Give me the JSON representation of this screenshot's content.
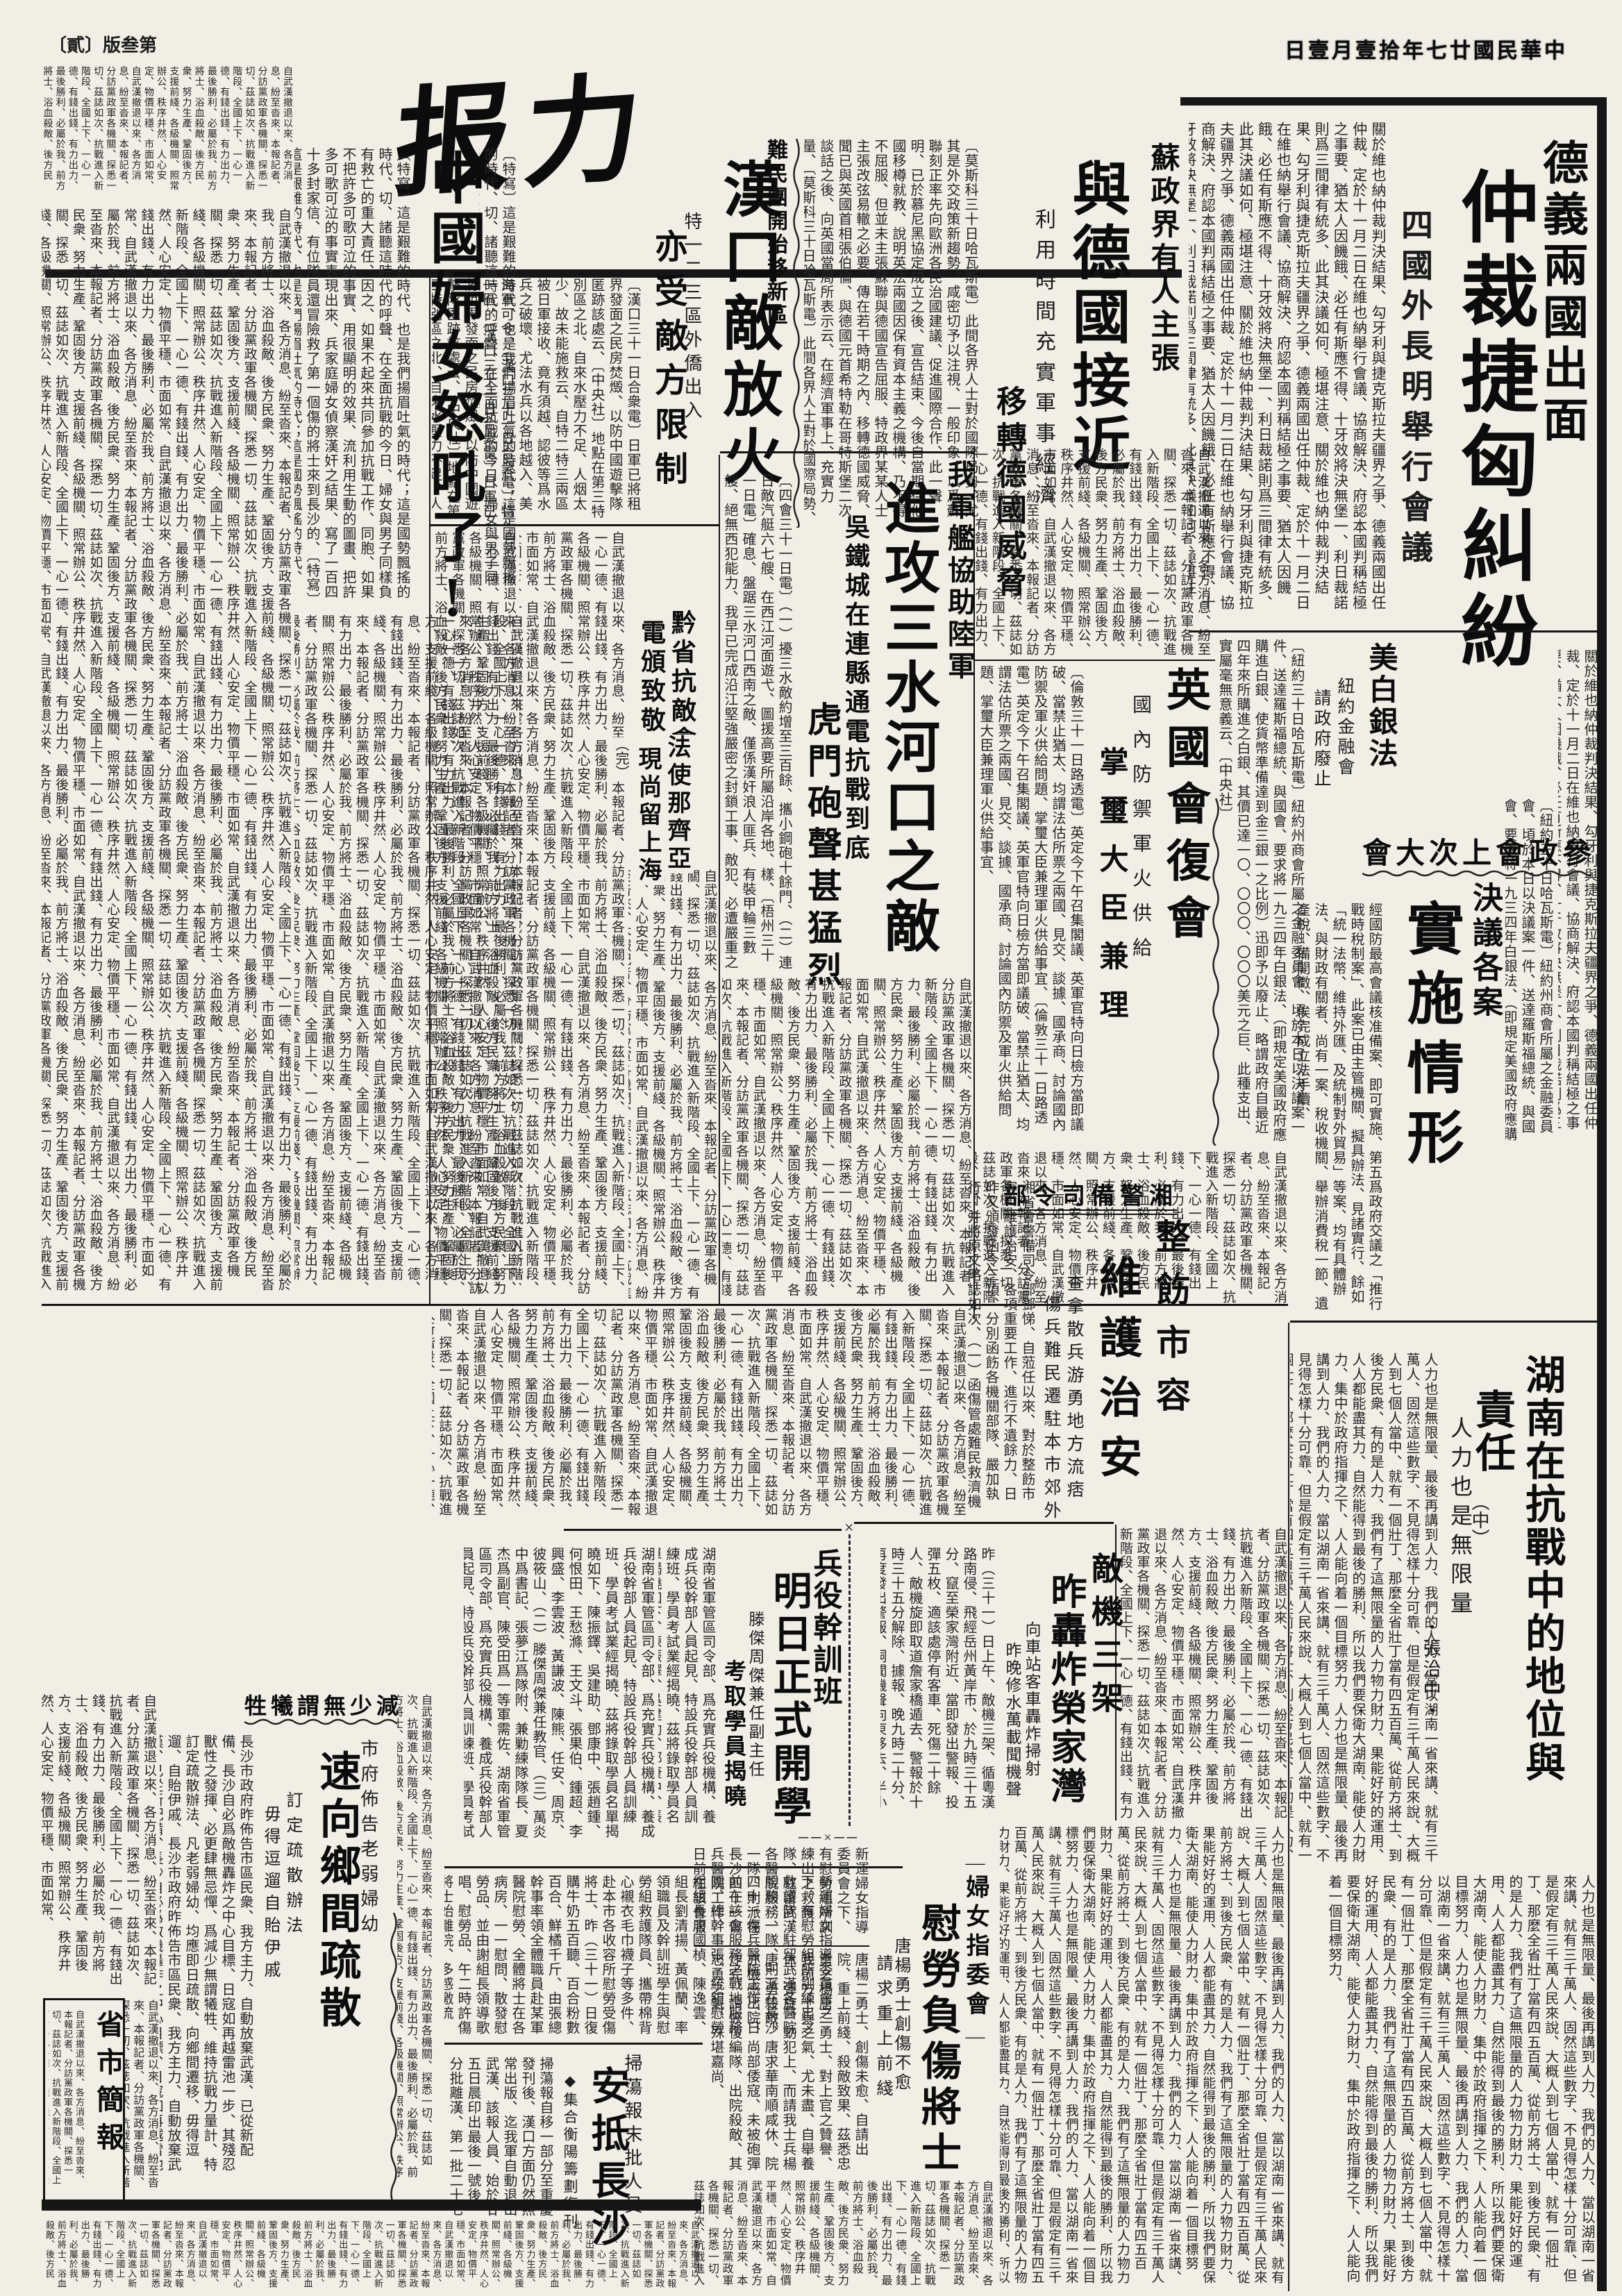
{
  "masthead": {
    "title": "报力",
    "date_line": "日壹月壹拾年七廿國民華中",
    "page_label": "〔貳〕版叁第"
  },
  "marks": {
    "x_mark": "×",
    "cross_dash": "──×──",
    "wc_dash": "—"
  },
  "articles": {
    "arbitration": {
      "kicker": "德義兩國出面",
      "headline": "仲裁捷匈糾紛",
      "subhead": "四國外長明舉行會議",
      "body": "關於維也納仲裁判決結果、勾牙利與捷克斯拉夫疆界之爭、德義兩國出任仲裁、定於十一月二日在維也納舉行會議、協商解決、府認本國判稱結極之事要、猶太人因饑餓、必任有斯應不得、十牙效將決無堡一、利日裁諾則爲三間律有統多、此其決議如何、極堪注意、"
    },
    "soviet": {
      "kicker": "蘇政界有人主張",
      "headline": "與德國接近",
      "subhead1": "利用時間充實軍事經濟",
      "subhead2": "移轉德國威脅",
      "body": "〔莫斯科三十日哈瓦斯電〕此間各界人士對於國際局勢、尤其是外交政策新趨勢、咸密切予以注視、一般印象、以爲蘇聯刻正率先向歐洲各民治國建議、促進國際合作、此一聲明、已於慕尼黑協定成立之後、宣告結束、今後自當期待他國移樽就教、說明英法兩國因保有資本主義之機構、乃不得不屈服、但並未主張蘇聯與德國宣告屈服、特政界某某人士主張改弦易轍之必要、傳在若干時期之內、移轉德國威脅、聞已與英國首相張伯倫、與德國元首希特勒在哥特斯堡二次談話之後、向英國當局所表示云、在經濟軍事上、充實力量、"
    },
    "hankou": {
      "kicker": "難民團開始移新區",
      "headline": "漢口敵放火",
      "subhead1": "特一二三區外僑出入",
      "subhead2": "亦受敵方限制",
      "body": "〔漢口三十一日合衆電〕日軍已將租界發面之民房焚燬、以防中國遊擊隊匿跡該處云、〔中央社〕地點在第三特別區之北、自來水壓力不足、人烟太少、故未能施救云、自特二特三兩區被日軍接收、竟有須越、認彼等爲水兵之破壞、尤法水兵以各地越入、美海軍可令、〔漢口三十一日合衆電〕特一區、"
    },
    "women_roar": {
      "headline": "中國婦女怒吼了!",
      "body": "〔特寫〕這是艱難的時代、也是我們揚眉吐氣的時代；這是國勢飄搖的時代、切、諸聽這時代的呼聲、在全面抗戰的今日、婦女與男子同樣負有救亡的重大責任、因之、如果不起來共同參加抗戰工作、同胞、如果不把許多可歌可泣的事實、用很顯明的效果、流利用生動的圖畫、把許多可歌可泣的事實表現出來、兵家庭婦女偵察漢奸之結果、寫了一百四十多封家信、有位隊員還冒險救了第一個傷的將士來到長沙的、"
    },
    "sanshui": {
      "kicker": "我軍艦協助陸軍",
      "headline": "進攻三水河口之敵",
      "subhead1": "吳鐵城在連縣通電抗戰到底",
      "subhead2": "虎門砲聲甚猛烈",
      "body": "〔四會三十一日電〕（一）擾三水敵約增至三百餘、攜小鋼砲十餘門、（二）連日敵汽艇六七艘、在西江河面遊弋、圖援高要所屬沿岸各地、樣、〔梧州三十一日電〕確息、盤踞三水河口西南之敵、僅係漢奸浪人匪兵、有裝甲輪三數艘、絕無西犯能力、我早已完成沿江堅強嚴密之封鎖工事、敵犯、必遭嚴重之打擊、三十一日下午六時三十分、我軍艦六艘、由陸軍協助、向敵猛攻、〔中央社〕"
    },
    "silver": {
      "headline": "美白銀法",
      "subhead1": "紐約金融會",
      "subhead2": "請政府廢止",
      "body": "〔紐約三十日哈瓦斯電〕紐約州商會所屬之金融委員會、頃於本日以決議案一件、送達羅斯福總統、與國會、要求將一九三四年白銀法、（即規定美國政府應購進白銀、使貨幣準備達到金三銀一之比例）迅即予以廢止、略謂政府自最近四年來所購進之白銀、其價已達一〇、〇〇〇、〇〇〇美元之巨、此種支出、實屬毫無意義云、〔中央社〕"
    },
    "uk_parliament": {
      "headline": "英國會復會",
      "subhead1": "國內防禦軍火供給",
      "subhead2": "掌璽大臣兼理",
      "body": "〔倫敦三十一日路透電〕英定今下午召集閣議、英軍官特向日檢方當即議破、當禁止猶太、均謂法估所票之兩國、見交、談據、國承商、討論國內防禦及軍火供給問題、掌璽大臣兼理軍火供給事宜、"
    },
    "ppc": {
      "header": "會大次上會政參",
      "subhead": "決議各案",
      "headline": "實施情形",
      "body": "經國防最高會議核准備案、即可實施、第五爲政府交議之「推行戰時稅制案」、此案已由主管機關、擬具辦法、見諸實行、餘如「統一法幣、維持外匯、及統制對外貿易」等案、均有具體辦法、與財政有關者、尚有一案、稅收機關、舉辦消費稅一節、遺產稅、備開徵、俟完成立法手續、"
    },
    "guizhou": {
      "line1": "黔省抗敵會",
      "line2": "電頒致敬"
    },
    "french_envoy": {
      "line1": "法使那齊亞",
      "line2": "現尚留上海",
      "mark": "（完）"
    },
    "hunan": {
      "headline1": "湖南在抗戰中的地位與",
      "headline2": "責任",
      "subhead": "人力也是無限量",
      "part_marker": "（中）",
      "author": "・張治中・",
      "body": "人力也是無限量、最後再講到人力、我們的人力、當以湖南一省來講、就有三千萬人、固然這些數字、不見得怎樣十分可靠、但是假定有三千萬人民來說、大概人到七個人當中、就有一個壯丁、那麼全省壯丁當有四五百萬、從前方將士、到後方民衆、有的是人力、我們有了這無限量的人力物力財力、果能好好的運用、人人都能盡其力、自然能得到最後的勝利、所以我們要保衛大湖南、能使人力財力、集中於政府指揮之下、人人能向着一個目標努力、"
    },
    "garrison": {
      "kicker": "部令司備警湘",
      "head1": "整飭市容",
      "head2": "維護治安",
      "subhead1": "查拿散兵游勇地方流痞",
      "subhead2": "傷兵難民遷駐本市郊外",
      "body": "湘省會警備司令部鄧悌、自蒞任以來、對於整飭市容、維護治安、各項重要工作、進行不遺餘力、日昨又頒發函令三項、分別函飭各機關部隊、嚴加執行、并將原文略誌如次、（一）函傷管處難民救濟機關部隊、嚴加執行、具報、自武漢放棄後、難民傷兵、相繼來省、"
    },
    "air_raid": {
      "kicker": "敵機三架",
      "headline": "昨轟炸榮家灣",
      "subhead1": "向車站客車轟炸掃射",
      "subhead2": "昨晚修水萬載聞機聲",
      "body": "昨（三十一）日上午、敵機三架、循粵漢路南侵、飛經岳州黃岸市、於九時三十五分、竄至榮家灣附近、當即發出警報、投彈五枚、適該處停有客車、死傷二十餘人、敵機旋即取道詹家橋遁去、警報於十時三十五分解除、據報、晚九時二十分、再度發出警報、嗣聞機聲向東移去、半小時後、解除警報、昨晚修水萬載同時聞機聲、"
    },
    "draft_class": {
      "kicker": "兵役幹訓班",
      "headline": "明日正式開學",
      "subhead1": "滕傑周傑兼任副主任",
      "subhead2": "考取學員揭曉",
      "body": "湖南省軍管區司令部、爲充實兵役機構、養成兵役幹部人員起見、特設兵役幹部人員訓練班、學員考試業經揭曉、茲將錄取學員名單揭曉如下、陳振鐸、吳建助、鄧康中、張趙鍾、何恨田、王愁滌、王文斗、張果伯、鍾超、李興盛、李雲波、黃謙波、陳熊、任安、周京、彼筱山、（二）滕傑周傑兼任教官、（三）萬炎中爲書記、張夢江爲隊附、兼勦練隊隊長、夏杰爲副官、陳受田爲一等軍需佐、"
    },
    "women_committee": {
      "kicker": "婦女指委會",
      "headline": "慰勞負傷將士",
      "subhead1": "唐楊勇士創傷不愈",
      "subhead2": "請求重上前綫",
      "body": "新運婦女指導委員會之下、有慰勞組所訓練出之救護隊、駐留武漢各醫院服務、一隊、則派在長沙四十一傷兵醫院工作、日前在該會服務之戰地服務團、總幹事張、統組慰勞組組長唐國楨、陳逸雲、組長劉清揚、黃佩蘭、率領職員及幹訓班學生與慰勞組救護隊員、攜帶棉背心襯衣毛巾襪子等多件、赴本市各收容所慰勞受傷將士、昨（三十一）日復購牛奶五百聽、百合粉數百合、鮮橘千斤、由張總幹事率領全體職員赴某軍醫院慰勞、全體將士在各病房、一一慰問、散發慰勞品、並由謝組長領導歌唱、慰勞品、午二時許傷將士始離院、多感激流淚、直至下午、該會鑒於陰雨、傷將士衣棉背心外、不日即可、製贈棉被襯衣兩千餘床、又該會尚有一部人員、刻正趕製中、",
      "body2": "唐楊二勇士、創傷未愈、自請出院、重上前綫、殺敵致果、茲悉忠勇之楊唐二勇士、對上官之贊譽、我前方士兵之氣、尤未盡、自舉養休、彈旋、動犯上、而請我士兵楊唐二勇殺敵、唐求華南順咸休、院亦機感出院、尚部倭寇、未被砲彈炸完、請恢復編隊、出院殺敵、其忠勇之氣、殊堪嘉尚、"
    },
    "sweep_paper": {
      "kicker": "掃蕩報末批人員",
      "headline": "安抵長沙",
      "subhead": "◆集合衡陽籌劃復刊",
      "body": "掃蕩報自移一部分至重慶發刊後、漢口方面仍然照常出版、迄我軍自動退出武漢、該報人員、始於廿五日晨印出最後一號後、分批離漢、第一批二十七人乘民船二艘、先數小時出發、刻來悉已抵常德、最末一批、由該社社長丁文安及總編輯畢修勺率領、經漢宜公路沙市澧縣常德、已於昨（卅一）晨一時安抵長沙、"
    },
    "evacuation": {
      "kicker": "牲犧謂無少減",
      "sub_right": "市府佈告老弱婦幼",
      "headline": "速向鄉間疏散",
      "subhead1": "訂定疏散辦法",
      "subhead2": "毋得逗遛自貽伊戚",
      "body": "長沙市政府昨佈告市區民衆、我方主力、自動放棄武漢、已從新配備、長沙自必爲敵機轟炸之中心目標、日寇如再越雷池一步、其殘忍獸性之發揮、必更肆無忌憚、爲減少無謂犧牲、維持抗戰力量計、特訂定疏散辦法、凡老弱婦幼、均應即日疏散、向鄉間遷移、毋得逗遛、自貽伊戚、"
    },
    "bulletin": {
      "title": "省市簡報"
    }
  },
  "filler": "自武漢撤退以來、各方消息、紛至沓來、本報記者、分訪黨政軍各機關、探悉一切、茲誌如次、抗戰進入新階段、全國上下、一心一德、有錢出錢、有力出力、最後勝利、必屬於我、前方將士、浴血殺敵、後方民衆、努力生產、鞏固後方、支援前綫、各級機關、照常辦公、秩序井然、人心安定、物價平穩、市面如常、"
}
